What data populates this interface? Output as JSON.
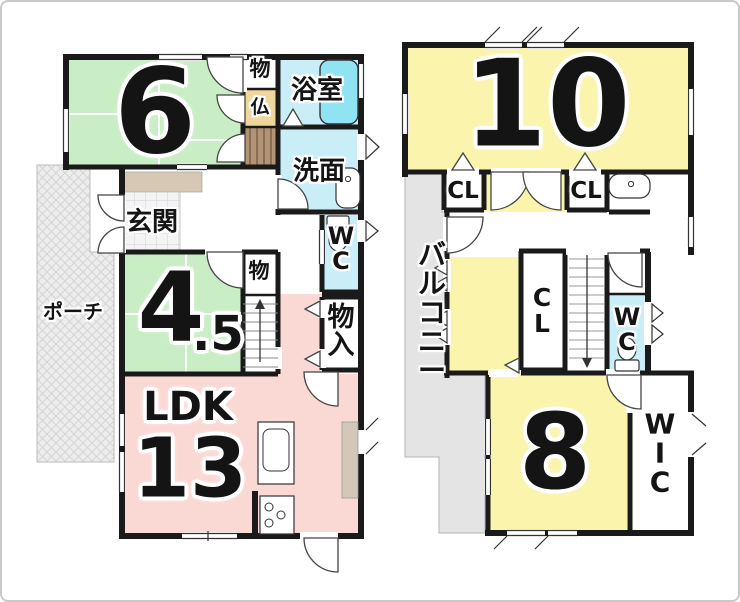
{
  "title": "2-story house floor plan",
  "floor1": {
    "room6": {
      "label": "6"
    },
    "closet_upper": {
      "label": "物"
    },
    "butsudan": {
      "label": "仏"
    },
    "bathroom": {
      "label": "浴室"
    },
    "washroom": {
      "label": "洗面"
    },
    "entrance": {
      "label": "玄関"
    },
    "porch": {
      "label": "ポーチ"
    },
    "toilet": {
      "label": "W\nC"
    },
    "room45": {
      "label_main": "4",
      "label_sub": ".5"
    },
    "closet_mid": {
      "label": "物"
    },
    "storage": {
      "label": "物\n入"
    },
    "ldk": {
      "name": "LDK",
      "size": "13"
    }
  },
  "floor2": {
    "room10": {
      "label": "10"
    },
    "closet_left": {
      "label": "CL"
    },
    "closet_right": {
      "label": "CL"
    },
    "balcony": {
      "label": "バ\nル\nコ\nニ\nー"
    },
    "closet_mid": {
      "label": "C\nL"
    },
    "toilet": {
      "label": "W\nC"
    },
    "room8": {
      "label": "8"
    },
    "wic": {
      "label": "W\nI\nC"
    }
  },
  "colors": {
    "wall": "#1a1a1a",
    "tatami_green": "#c9eec5",
    "room_yellow": "#faf4ad",
    "ldk_pink": "#fad9d5",
    "wet_cyan": "#c9eef8",
    "bathtub_cyan": "#8fe3f3",
    "altar_tan": "#efd79b",
    "stairs_brown": "#b29474",
    "balcony_gray": "#e4e4e4",
    "step_tan": "#d6c8b2"
  }
}
